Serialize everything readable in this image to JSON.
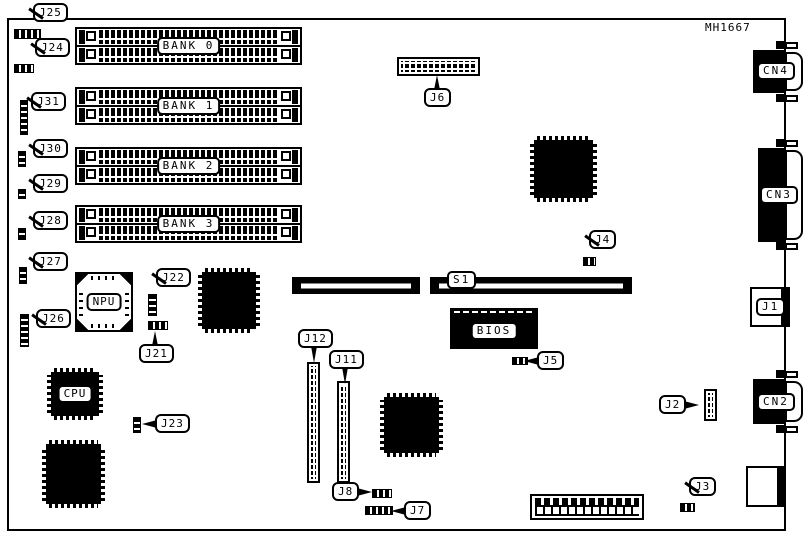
{
  "part_number": "MH1667",
  "banks": {
    "b0": "BANK 0",
    "b1": "BANK 1",
    "b2": "BANK 2",
    "b3": "BANK 3"
  },
  "chips": {
    "npu": "NPU",
    "cpu": "CPU",
    "bios": "BIOS"
  },
  "slots": {
    "s1": "S1"
  },
  "edge_connectors": {
    "cn4": "CN4",
    "cn3": "CN3",
    "cn2": "CN2",
    "j1": "J1"
  },
  "labels": {
    "j25": "J25",
    "j24": "J24",
    "j31": "J31",
    "j30": "J30",
    "j29": "J29",
    "j28": "J28",
    "j27": "J27",
    "j26": "J26",
    "j22": "J22",
    "j21": "J21",
    "j23": "J23",
    "j6": "J6",
    "j4": "J4",
    "j5": "J5",
    "j12": "J12",
    "j11": "J11",
    "j8": "J8",
    "j7": "J7",
    "j2": "J2",
    "j3": "J3"
  },
  "colors": {
    "ink": "#000000",
    "paper": "#ffffff"
  }
}
